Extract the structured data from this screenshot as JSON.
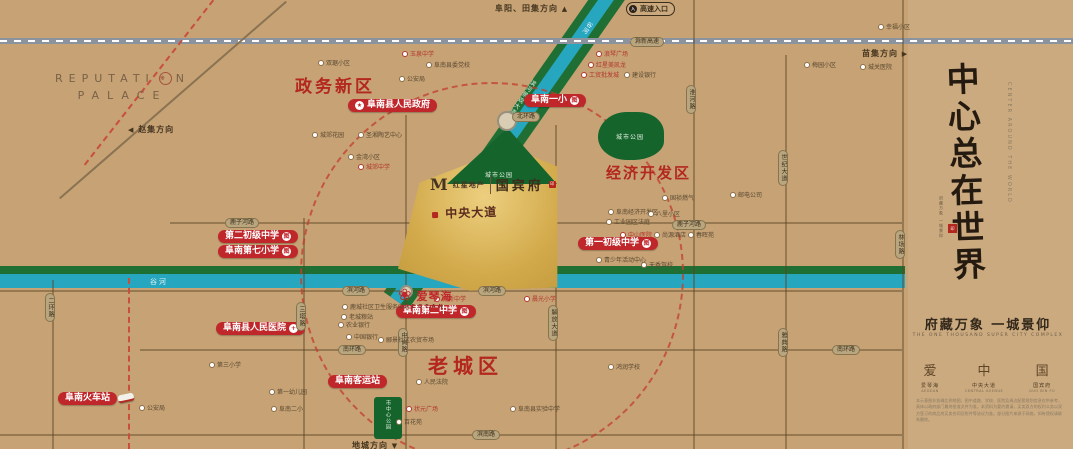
{
  "map": {
    "directions": {
      "north": "阜阳、田集方向",
      "north_arrow": "▲",
      "east": "苗集方向",
      "east_arrow": "▶",
      "west": "赵集方向",
      "west_arrow": "◀",
      "south": "地城方向",
      "south_arrow": "▼",
      "highway_entrance": "高速入口",
      "highway_entrance_icon": "入"
    },
    "districts": {
      "zhengwu": "政务新区",
      "jingji": "经济开发区",
      "laocheng": "老城区"
    },
    "red_labels": [
      {
        "text": "阜南县人民政府",
        "badge": "★"
      },
      {
        "text": "阜南一小",
        "badge": "图"
      },
      {
        "text": "第二初级中学",
        "badge": "图"
      },
      {
        "text": "阜南第七小学",
        "badge": "图"
      },
      {
        "text": "第一初级中学",
        "badge": "图"
      },
      {
        "text": "阜南第二中学",
        "badge": "图"
      },
      {
        "text": "阜南县人民医院",
        "badge": "+"
      },
      {
        "text": "阜南客运站"
      },
      {
        "text": "阜南火车站"
      }
    ],
    "parks": [
      {
        "name": "城市公园"
      },
      {
        "name": "城市公园"
      },
      {
        "name": "市中心公园"
      }
    ],
    "waterways": {
      "river": "谷河",
      "corridor": "滨河景观大道",
      "highway": "滁新高速"
    },
    "road_tags_h": [
      "滁新高速",
      "鹿子河路",
      "鹿子河路",
      "滨河路",
      "滨河路",
      "南环路",
      "南环路",
      "滨南路",
      "北环路"
    ],
    "road_tags_v": [
      "二环路",
      "三塔路",
      "中岗路",
      "解放大道",
      "淮河路",
      "世纪大道",
      "雅典路",
      "林场路"
    ],
    "pois": [
      {
        "text": "双琚小区"
      },
      {
        "text": "玉泉中学"
      },
      {
        "text": "阜南县委党校"
      },
      {
        "text": "公安局"
      },
      {
        "text": "城郊花园"
      },
      {
        "text": "圣湘陶艺中心"
      },
      {
        "text": "金湾小区"
      },
      {
        "text": "城郊中学"
      },
      {
        "text": "浪琴广场"
      },
      {
        "text": "红星美凯龙"
      },
      {
        "text": "工贸批发城"
      },
      {
        "text": "建设银行"
      },
      {
        "text": "幸福小区"
      },
      {
        "text": "梅园小区"
      },
      {
        "text": "国祯燃气"
      },
      {
        "text": "阜南经济开发区"
      },
      {
        "text": "工业园区法庭"
      },
      {
        "text": "八里小区"
      },
      {
        "text": "中山医院"
      },
      {
        "text": "尚源酒店"
      },
      {
        "text": "春晖苑"
      },
      {
        "text": "青少年活动中心"
      },
      {
        "text": "天香驾校"
      },
      {
        "text": "育新中学"
      },
      {
        "text": "晨光小学"
      },
      {
        "text": "鹿城社区卫生服务中心"
      },
      {
        "text": "老城粮站"
      },
      {
        "text": "农业银行"
      },
      {
        "text": "中国银行"
      },
      {
        "text": "郦景社区农贸市场"
      },
      {
        "text": "人民法院"
      },
      {
        "text": "状元广场"
      },
      {
        "text": "阜南县实验中学"
      },
      {
        "text": "百花苑"
      },
      {
        "text": "公安局"
      },
      {
        "text": "第三小学"
      },
      {
        "text": "第一幼儿园"
      },
      {
        "text": "阜南二小"
      },
      {
        "text": "鸿润学校"
      },
      {
        "text": "城关医院"
      },
      {
        "text": "邮电公司"
      }
    ]
  },
  "project": {
    "developer_mark": "M",
    "developer_name": "红星地产",
    "name": "国宾府",
    "central_avenue": "中央大道",
    "aegean_cn": "爱琴海",
    "aegean_en": "AEGEAN",
    "aegean_icon": "❀",
    "seal_char": "印"
  },
  "reputation": {
    "part1": "REPUTATI",
    "o_char": "❋",
    "part2": "N",
    "line2": "PALACE"
  },
  "panel": {
    "slogan": "中心总在世界",
    "slogan_en": "CENTER AROUND THE WORLD",
    "mini_caption": "府藏万象 一城景仰",
    "seal_char": "印",
    "tagline": "府藏万象 一城景仰",
    "tagline_en": "THE ONE THOUSAND SUPER CITY COMPLEX",
    "products": [
      {
        "icon": "爱",
        "cn": "爱琴海",
        "en": "AEGEAN"
      },
      {
        "icon": "中",
        "cn": "中央大道",
        "en": "CENTRAL AVENUE"
      },
      {
        "icon": "国",
        "cn": "国宾府",
        "en": "GUO BIN FU"
      }
    ],
    "disclaimer": "本示意图非准确比例地图，图中道路、学校、医院及周边配套规划信息仅供参考，具体以政府部门最终批准文件为准。本资料为要约邀请，买卖双方的权利义务以双方签订的商品房买卖合同及附件等协议为准。部分图片来源于网络，如有侵权请联系删除。"
  }
}
